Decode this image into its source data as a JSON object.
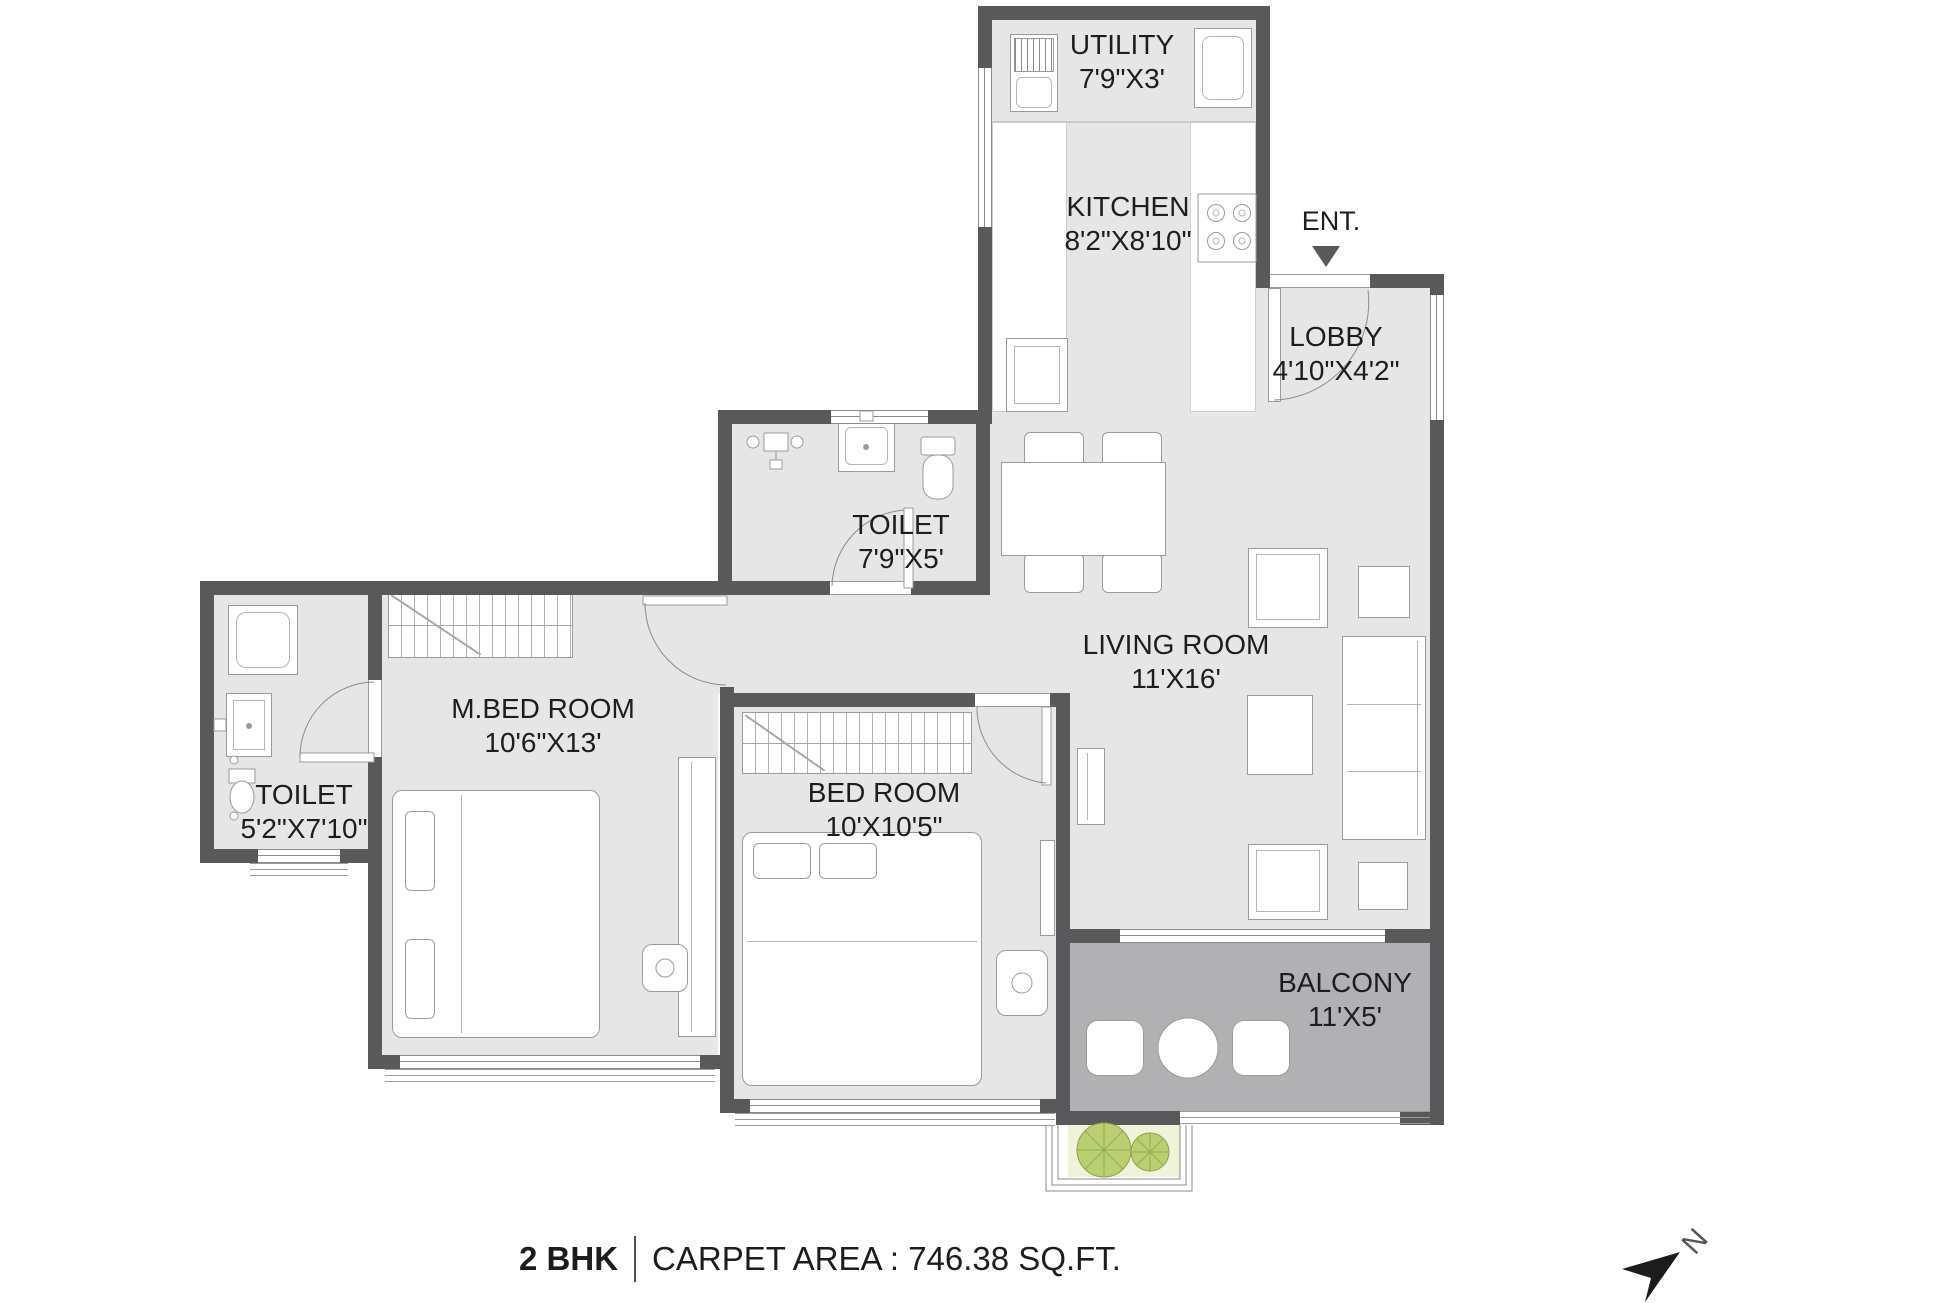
{
  "title_block": {
    "bhk": "2 BHK",
    "carpet": "CARPET AREA : 746.38 SQ.FT."
  },
  "entrance": {
    "label": "ENT."
  },
  "north": {
    "label": "N"
  },
  "rooms": {
    "utility": {
      "name": "UTILITY",
      "dims": "7'9\"X3'"
    },
    "kitchen": {
      "name": "KITCHEN",
      "dims": "8'2\"X8'10\""
    },
    "lobby": {
      "name": "LOBBY",
      "dims": "4'10\"X4'2\""
    },
    "toilet_common": {
      "name": "TOILET",
      "dims": "7'9\"X5'"
    },
    "living": {
      "name": "LIVING ROOM",
      "dims": "11'X16'"
    },
    "master_bedroom": {
      "name": "M.BED ROOM",
      "dims": "10'6\"X13'"
    },
    "bedroom": {
      "name": "BED ROOM",
      "dims": "10'X10'5\""
    },
    "toilet_master": {
      "name": "TOILET",
      "dims": "5'2\"X7'10\""
    },
    "balcony": {
      "name": "BALCONY",
      "dims": "11'X5'"
    }
  },
  "colors": {
    "wall": "#58595b",
    "floor": "#e6e6e7",
    "balcony_floor": "#b1b1b4",
    "planter": "#eef3da",
    "plant": "#b9cf72",
    "text": "#1d1d1f"
  },
  "icons": [
    "entrance-arrow-icon",
    "north-arrow-icon",
    "washing-machine-icon",
    "utility-sink-icon",
    "stove-icon",
    "kitchen-sink-icon",
    "wc-icon",
    "washbasin-icon",
    "shower-icon",
    "bathtub-icon",
    "wardrobe-icon",
    "double-bed-icon",
    "dining-set-icon",
    "sofa-icon",
    "armchair-icon",
    "coffee-table-icon",
    "tv-unit-icon",
    "balcony-seating-icon",
    "plant-icon"
  ]
}
